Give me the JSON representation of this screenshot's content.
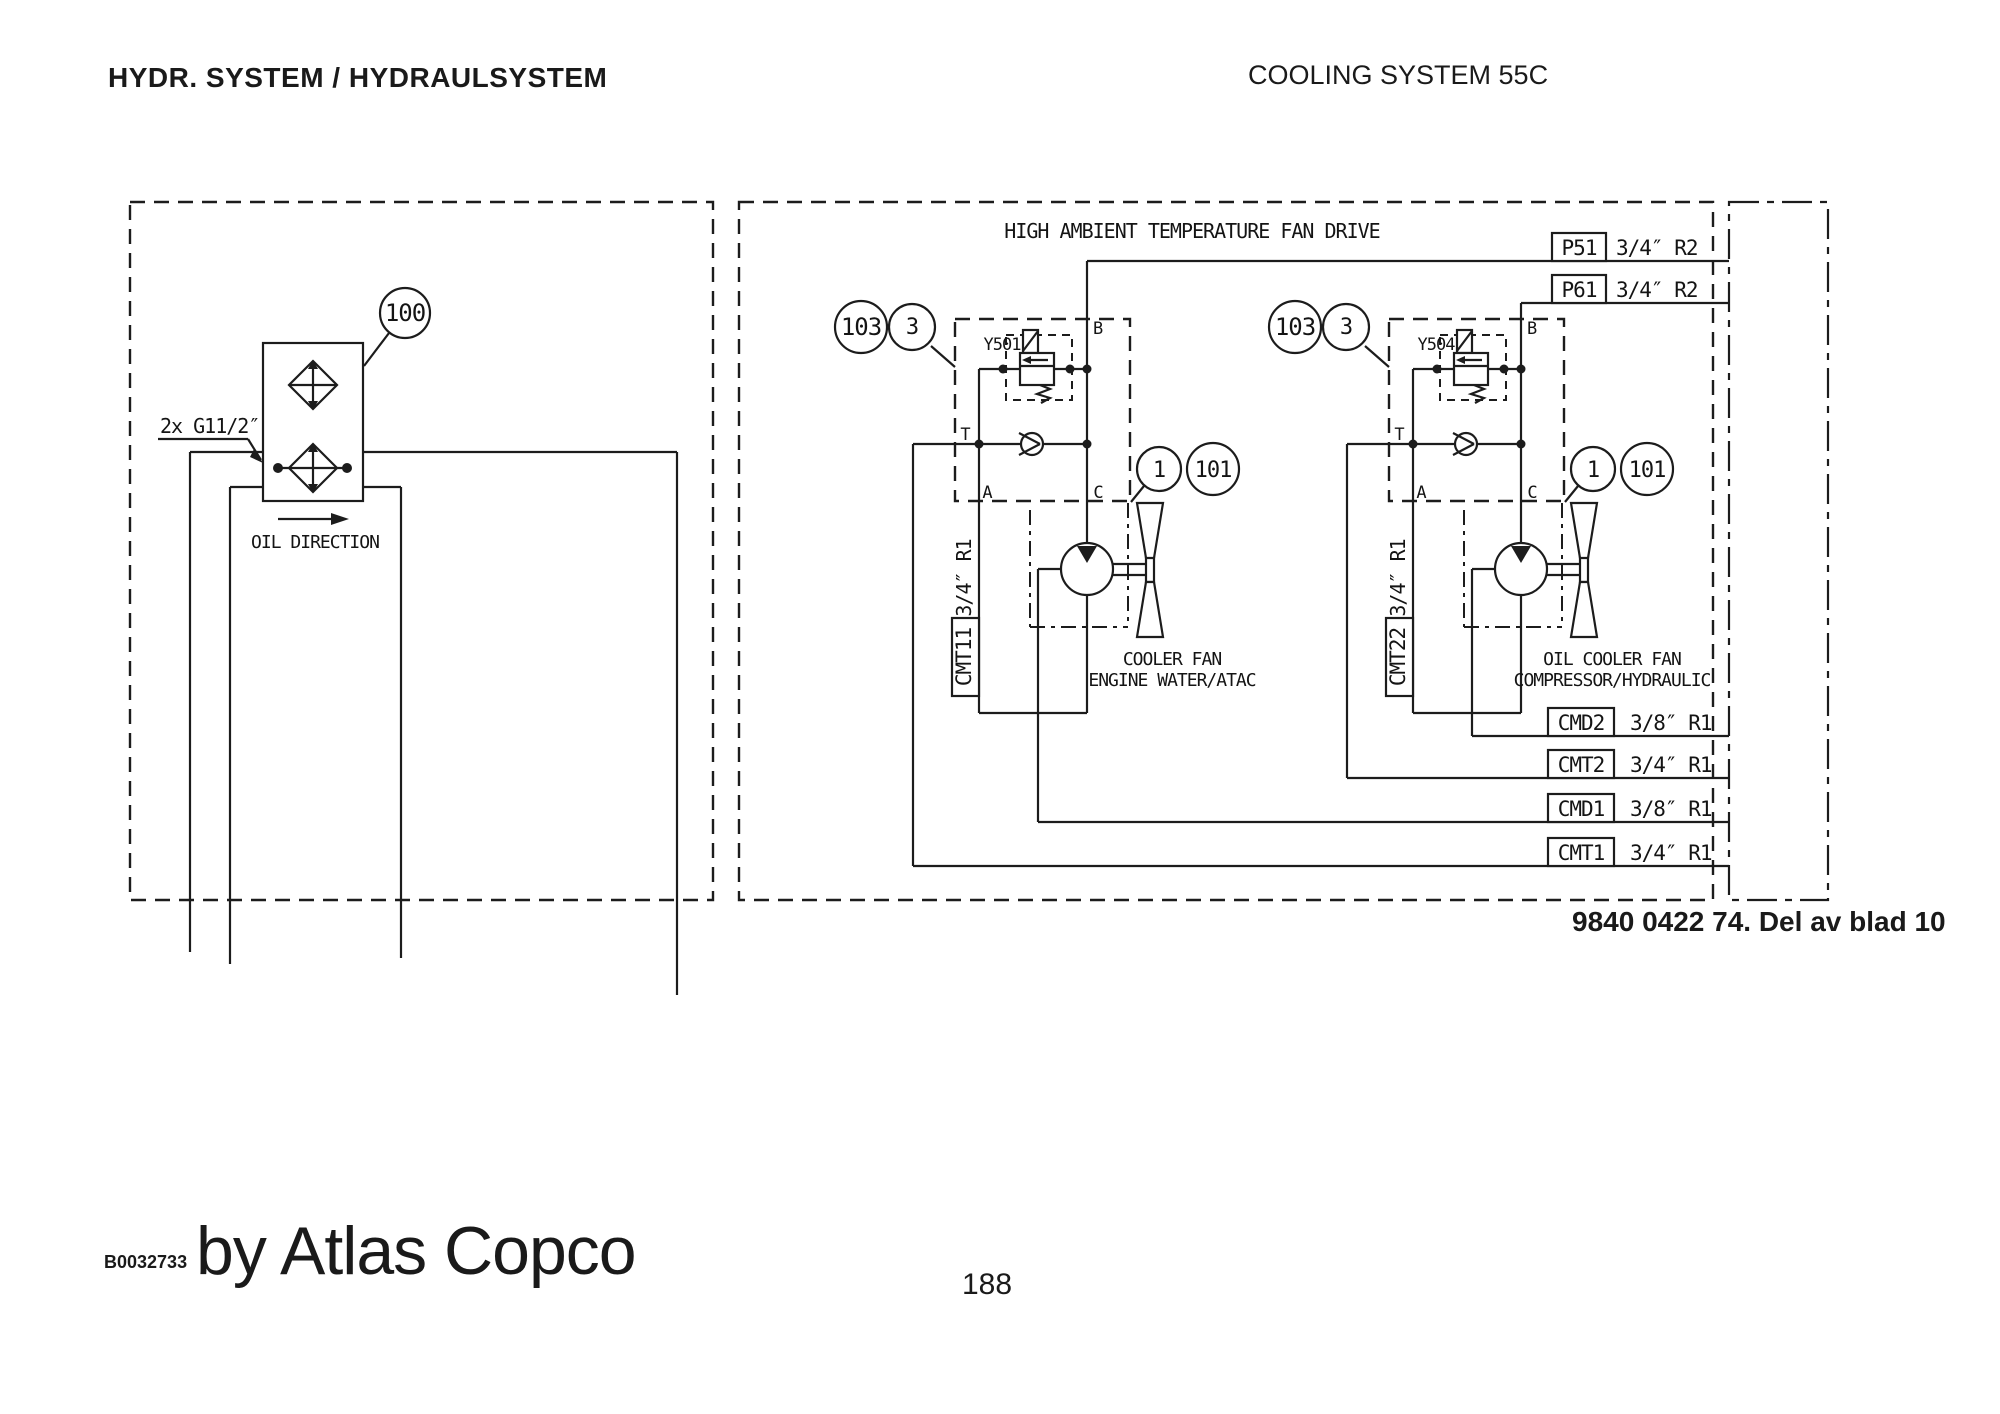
{
  "style": {
    "line_color": "#1c1c1c",
    "background": "#ffffff"
  },
  "page": {
    "header_left": "HYDR. SYSTEM / HYDRAULSYSTEM",
    "header_right": "COOLING SYSTEM 55C",
    "doc_ref": "9840 0422 74. Del av blad 10",
    "footer_code": "B0032733",
    "footer_brand": "by Atlas Copco",
    "page_number": "188"
  },
  "cooler_section": {
    "callout": "100",
    "port_note": "2x G11/2″",
    "flow_label": "OIL DIRECTION"
  },
  "fan_drive_section": {
    "title": "HIGH AMBIENT TEMPERATURE FAN DRIVE",
    "interface_ports": [
      {
        "label": "P51",
        "size": "3/4″ R2"
      },
      {
        "label": "P61",
        "size": "3/4″ R2"
      },
      {
        "label": "CMD2",
        "size": "3/8″ R1"
      },
      {
        "label": "CMT2",
        "size": "3/4″ R1"
      },
      {
        "label": "CMD1",
        "size": "3/8″ R1"
      },
      {
        "label": "CMT1",
        "size": "3/4″ R1"
      }
    ],
    "circuits": [
      {
        "name": "engine-water-cooler-fan",
        "callouts": [
          "103",
          "3"
        ],
        "item_callouts": [
          "1",
          "101"
        ],
        "valve_id": "Y501",
        "line_port": {
          "label": "CMT11",
          "size": "3/4″ R1"
        },
        "ports": {
          "b": "B",
          "t": "T",
          "a": "A",
          "c": "C"
        },
        "caption_line1": "COOLER FAN",
        "caption_line2": "ENGINE WATER/ATAC"
      },
      {
        "name": "oil-cooler-fan",
        "callouts": [
          "103",
          "3"
        ],
        "item_callouts": [
          "1",
          "101"
        ],
        "valve_id": "Y504",
        "line_port": {
          "label": "CMT22",
          "size": "3/4″ R1"
        },
        "ports": {
          "b": "B",
          "t": "T",
          "a": "A",
          "c": "C"
        },
        "caption_line1": "OIL COOLER FAN",
        "caption_line2": "COMPRESSOR/HYDRAULIC"
      }
    ]
  }
}
